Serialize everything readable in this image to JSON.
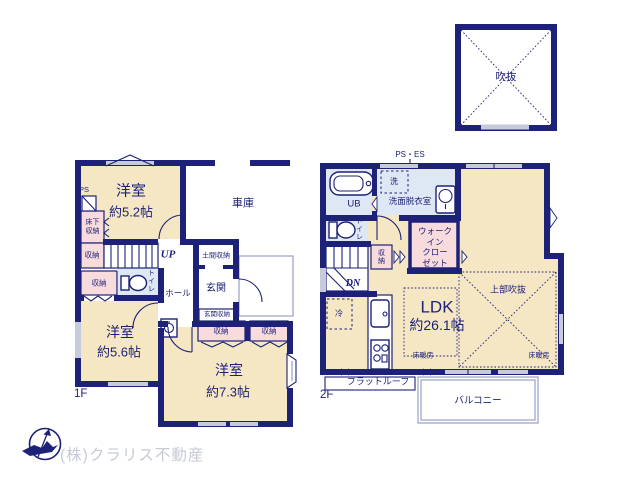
{
  "palette": {
    "navy": "#1d2178",
    "cream": "#f5e7c4",
    "pink": "#f8dbdc",
    "blue": "#dde8f4",
    "window_gray": "#c6cada",
    "light_outline": "#99a0c4",
    "company_gray": "#c6cad6",
    "bg": "#ffffff"
  },
  "void_room": {
    "label": "吹抜"
  },
  "floor1": {
    "floor_label": "1F",
    "bedroom_52": {
      "name": "洋室",
      "size": "約5.2帖"
    },
    "garage": "車庫",
    "ps": "PS",
    "underfloor_storage": "床下収納",
    "storage": "収納",
    "toilet": "トイレ",
    "hall": "ホール",
    "stairs_up": "UP",
    "doma_storage": "土間収納",
    "entrance": "玄関",
    "entrance_storage": "玄関収納",
    "bedroom_56": {
      "name": "洋室",
      "size": "約5.6帖"
    },
    "bedroom_73": {
      "name": "洋室",
      "size": "約7.3帖"
    }
  },
  "floor2": {
    "floor_label": "2F",
    "ps_es": "PS・ES",
    "unit_bath": "UB",
    "laundry": "洗",
    "washroom": "洗面脱衣室",
    "toilet": "トイレ",
    "stairs_down": "DN",
    "storage": "収納",
    "walk_in_closet_lines": [
      "ウォーク",
      "イン",
      "クロー",
      "ゼット"
    ],
    "ldk": {
      "name": "LDK",
      "size": "約26.1帖"
    },
    "floor_heating": "床暖房",
    "upper_void": "上部吹抜",
    "refrigerator": "冷",
    "flat_roof": "フラットルーフ",
    "balcony": "バルコニー"
  },
  "footer": {
    "company": "(株)クラリス不動産"
  }
}
